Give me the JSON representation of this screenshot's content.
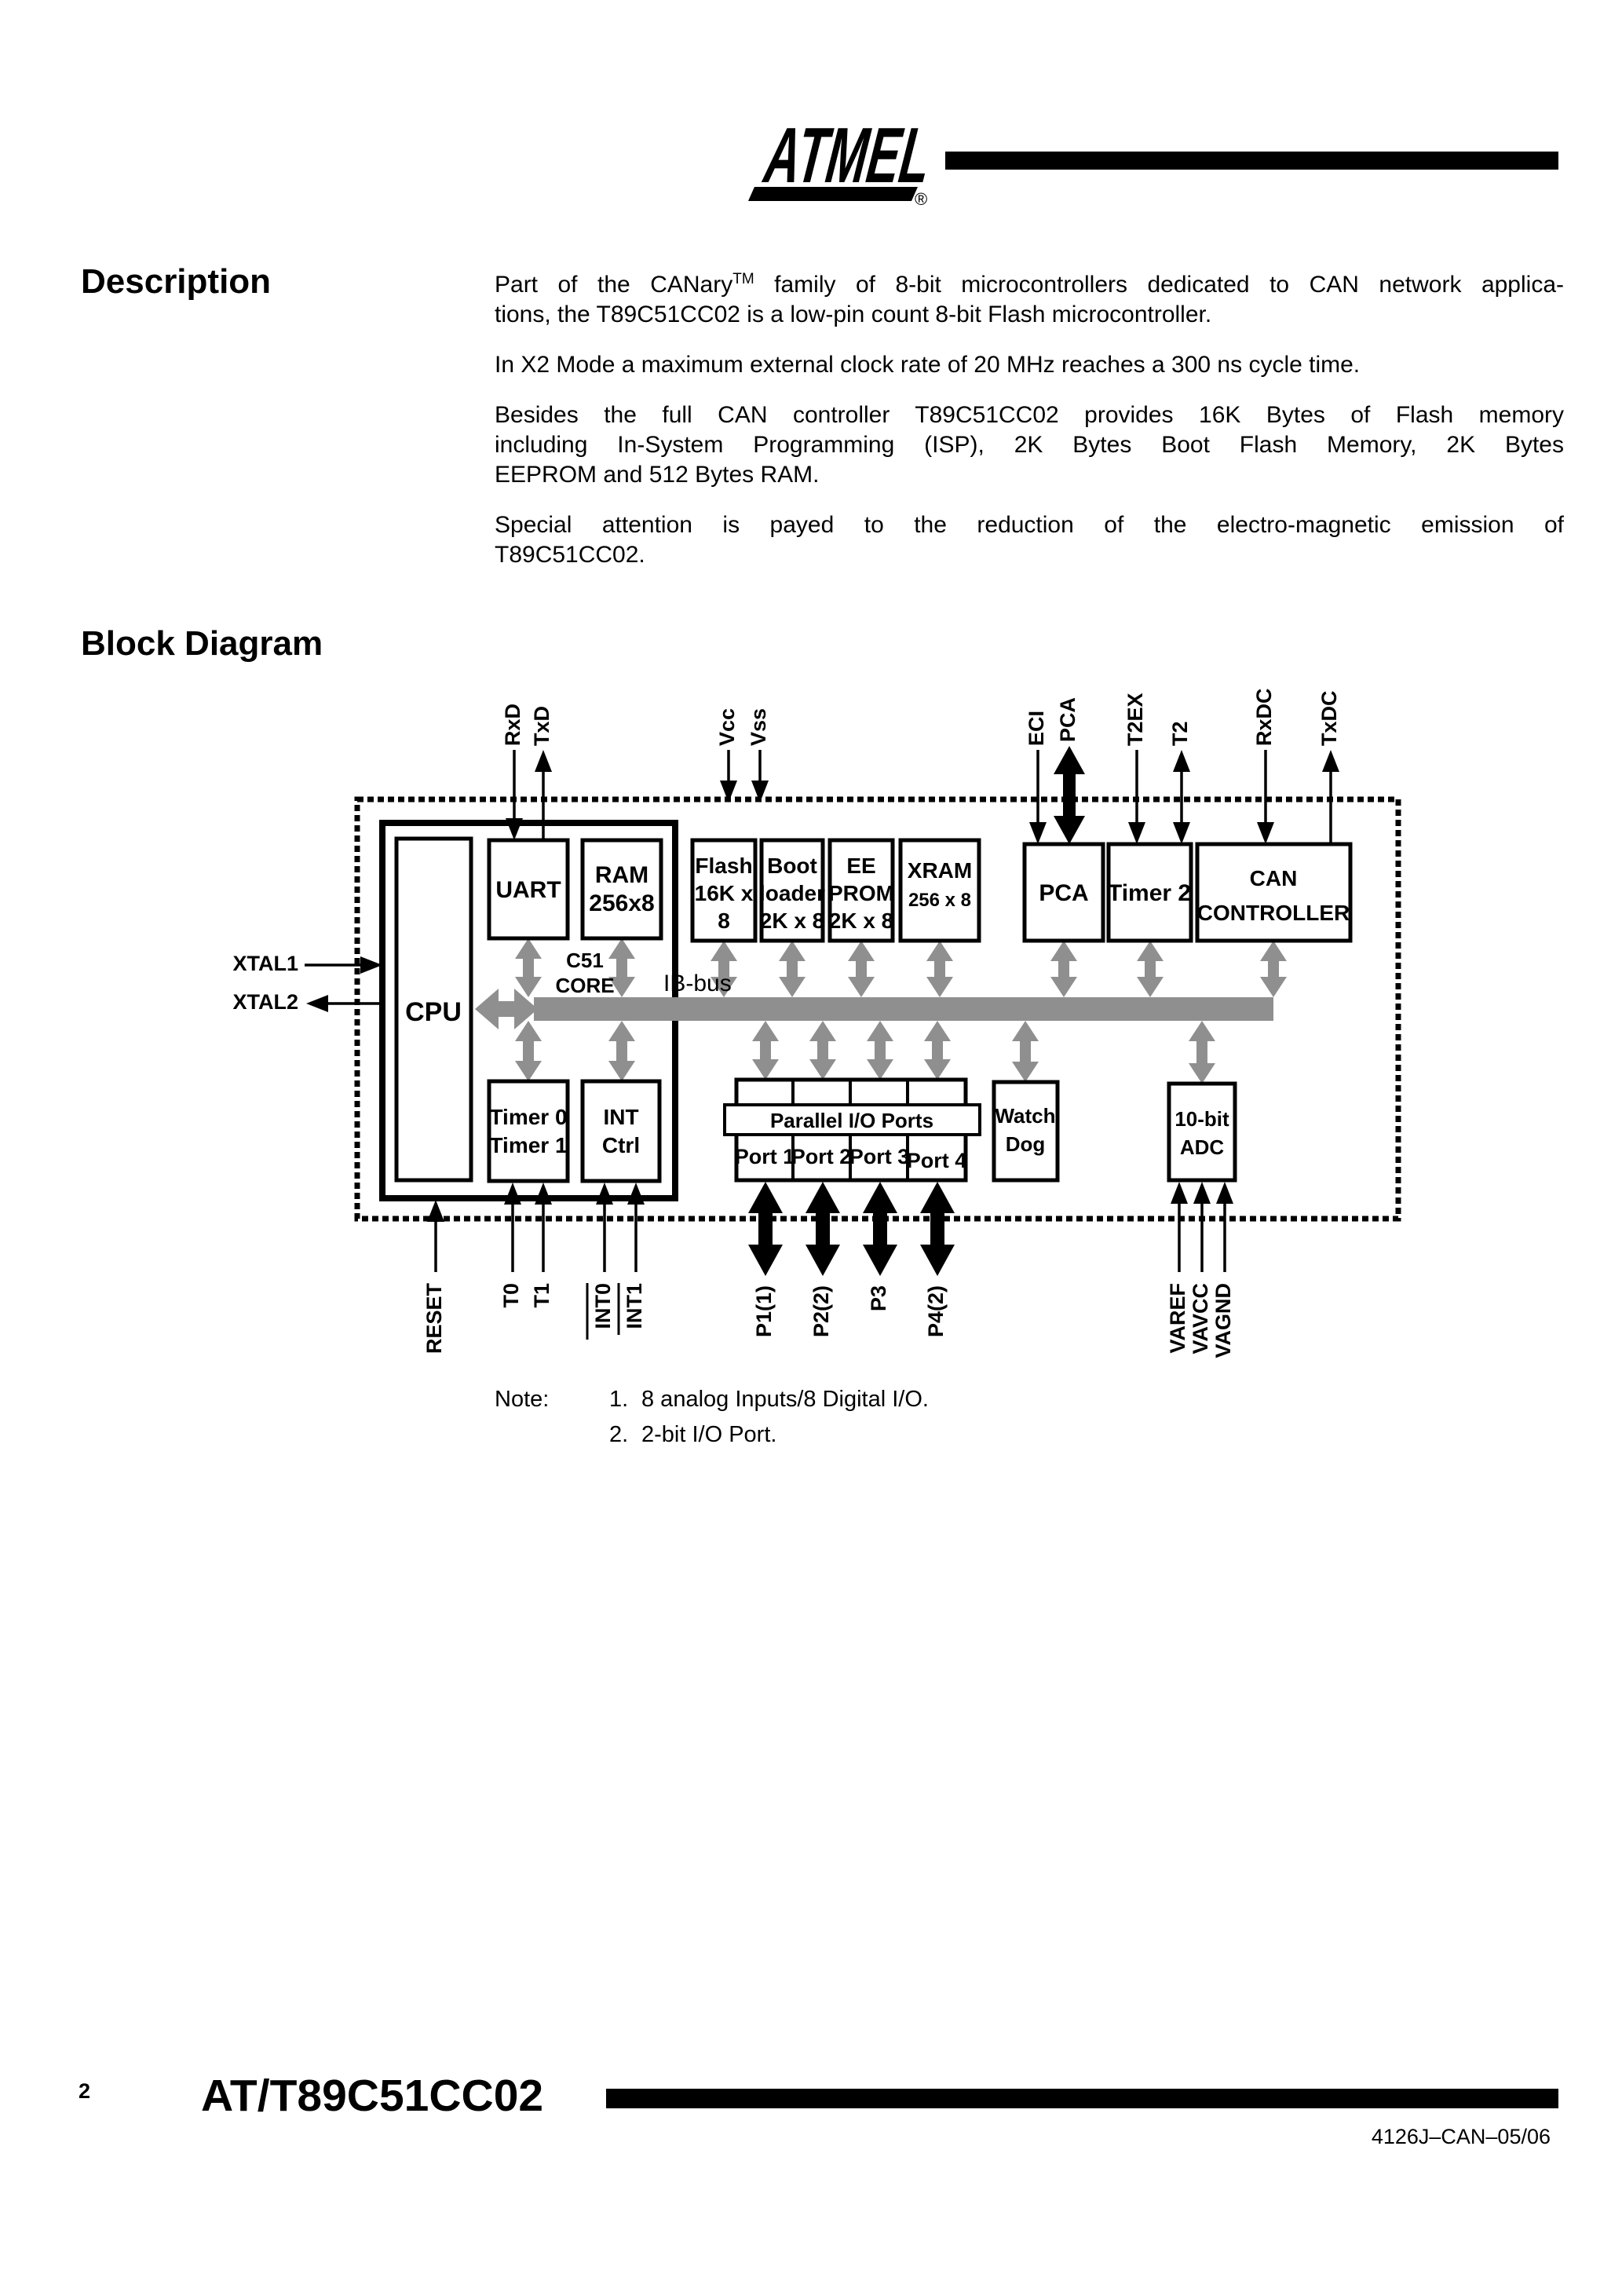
{
  "colors": {
    "ink": "#000000",
    "paper": "#ffffff",
    "bus_grey": "#8f8f8f"
  },
  "logo": {
    "brand": "ATMEL",
    "registered": "®"
  },
  "description": {
    "heading": "Description",
    "p1_l1a": "Part of the CANary",
    "p1_tm": "TM",
    "p1_l1b": " family of 8-bit microcontrollers dedicated to CAN network applica-",
    "p1_l2": "tions, the T89C51CC02 is a low-pin count 8-bit Flash microcontroller.",
    "p2_l1": "In X2 Mode a maximum external clock rate of 20 MHz reaches a 300 ns cycle time.",
    "p3_l1": "Besides the full CAN controller T89C51CC02 provides 16K Bytes of Flash memory",
    "p3_l2": "including In-System Programming (ISP), 2K Bytes Boot Flash Memory, 2K Bytes",
    "p3_l3": "EEPROM and 512 Bytes RAM.",
    "p4_l1": "Special attention is payed to the reduction of the electro-magnetic emission of",
    "p4_l2": "T89C51CC02."
  },
  "diagram": {
    "heading": "Block Diagram",
    "pins": {
      "rxd": "RxD",
      "txd": "TxD",
      "vcc": "Vcc",
      "vss": "Vss",
      "eci": "ECI",
      "pca": "PCA",
      "t2ex": "T2EX",
      "t2": "T2",
      "rxdc": "RxDC",
      "txdc": "TxDC",
      "xtal1": "XTAL1",
      "xtal2": "XTAL2",
      "reset": "RESET",
      "t0": "T0",
      "t1": "T1",
      "int0": "INT0",
      "int1": "INT1",
      "p1": "P1(1)",
      "p2": "P2(2)",
      "p3": "P3",
      "p4": "P4(2)",
      "varef": "VAREF",
      "vavcc": "VAVCC",
      "vagnd": "VAGND"
    },
    "blocks": {
      "cpu": "CPU",
      "core_l1": "C51",
      "core_l2": "CORE",
      "ibbus": "IB-bus",
      "uart": "UART",
      "ram_l1": "RAM",
      "ram_l2": "256x8",
      "flash_l1": "Flash",
      "flash_l2": "16K x",
      "flash_l3": "8",
      "boot_l1": "Boot",
      "boot_l2": "loader",
      "boot_l3": "2K x 8",
      "eeprom_l1": "EE",
      "eeprom_l2": "PROM",
      "eeprom_l3": "2K x 8",
      "xram_l1": "XRAM",
      "xram_l2": "256 x 8",
      "pca": "PCA",
      "timer2": "Timer 2",
      "can_l1": "CAN",
      "can_l2": "CONTROLLER",
      "timer01_l1": "Timer 0",
      "timer01_l2": "Timer 1",
      "int_l1": "INT",
      "int_l2": "Ctrl",
      "pio": "Parallel I/O Ports",
      "port1": "Port 1",
      "port2": "Port 2",
      "port3": "Port 3",
      "port4": "Port 4",
      "watchdog_l1": "Watch",
      "watchdog_l2": "Dog",
      "adc_l1": "10-bit",
      "adc_l2": "ADC"
    }
  },
  "note": {
    "label": "Note:",
    "item1_num": "1.",
    "item1_text": "8 analog Inputs/8 Digital I/O.",
    "item2_num": "2.",
    "item2_text": "2-bit I/O Port."
  },
  "footer": {
    "page_number": "2",
    "title": "AT/T89C51CC02",
    "doc_id": "4126J–CAN–05/06"
  }
}
